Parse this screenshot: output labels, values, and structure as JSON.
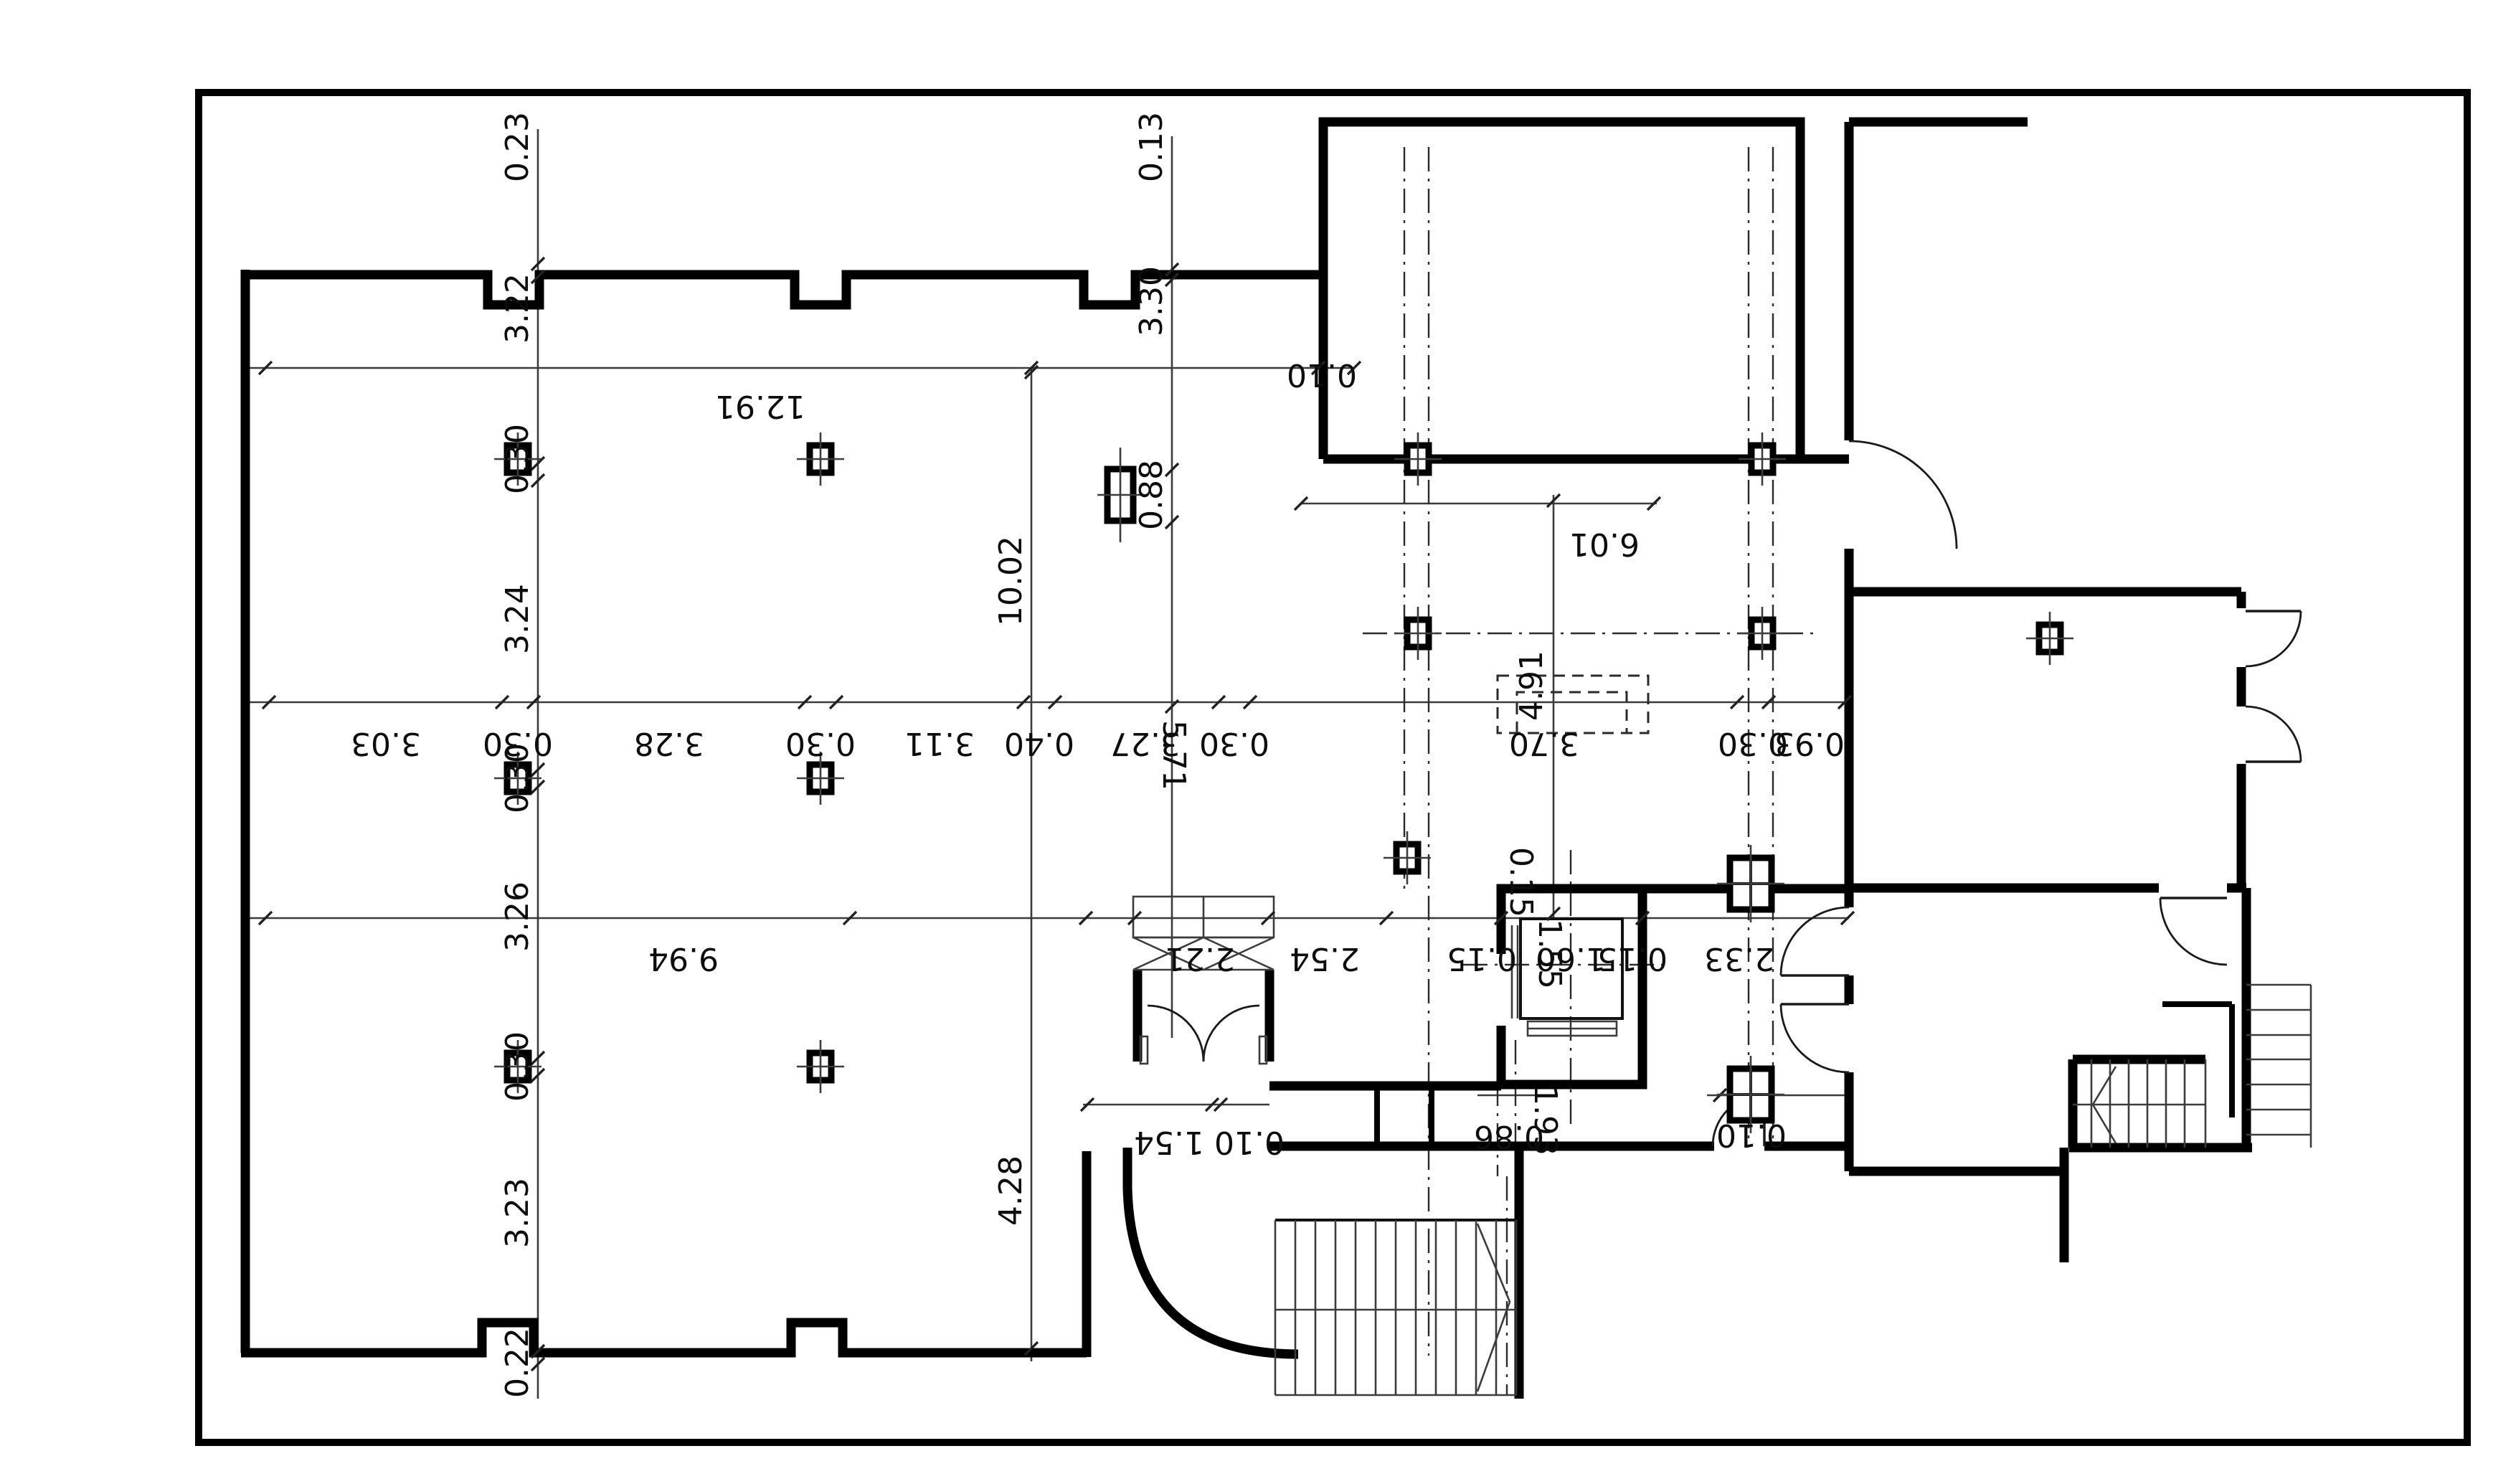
{
  "drawing": {
    "kind": "architectural floor plan",
    "colors": {
      "paper": "#ffffff",
      "ink": "#0d0d0d",
      "dimline": "#3c3c3c"
    }
  },
  "dims": {
    "left_chain": [
      "0.23",
      "3.22",
      "0.30",
      "3.24",
      "0.30",
      "3.26",
      "0.30",
      "3.23",
      "0.22"
    ],
    "main_chain": [
      "3.03",
      "0.30",
      "3.28",
      "0.30",
      "3.11",
      "0.40",
      "3.27",
      "0.30",
      "3.70",
      "0.30",
      "0.93"
    ],
    "mid_chain": [
      "9.94",
      "2.21",
      "2.54",
      "2.33"
    ],
    "elevator": {
      "wall_top": "0.15",
      "wall_left": "0.15",
      "depth": "1.55",
      "width": "1.60",
      "wall_right": "0.15"
    },
    "width_top": "12.91",
    "top_wall_t": "0.10",
    "axis_offset": "0.13",
    "axis_span": "3.30",
    "pier_h": "0.88",
    "hall_depth": "10.02",
    "canopy_w": "6.01",
    "canopy_d": "4.91",
    "stair_axis": "5.71",
    "lower_depth": "4.28",
    "entry_a": "1.54",
    "entry_b": "0.10",
    "stair_a": "0.86",
    "stair_b": "1.93",
    "door_off": "0.10"
  }
}
